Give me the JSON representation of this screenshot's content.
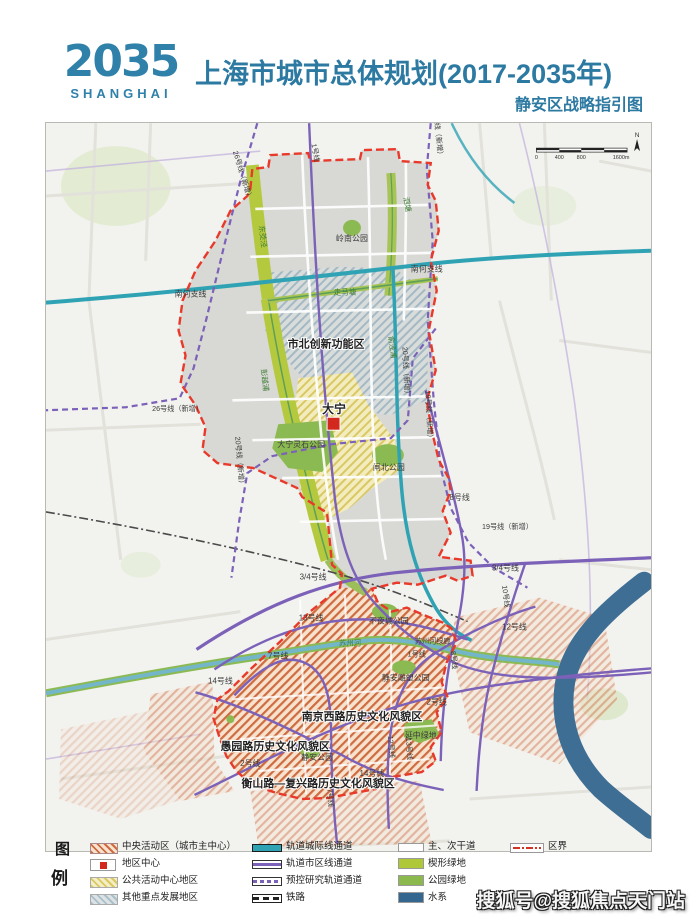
{
  "header": {
    "logo_year": "2035",
    "logo_city": "SHANGHAI",
    "title": "上海市城市总体规划(2017-2035年)",
    "subtitle": "静安区战略指引图"
  },
  "map": {
    "scale_bar": {
      "t0": "0",
      "t400": "400",
      "t800": "800",
      "t1600": "1600m",
      "north": "N"
    },
    "labels": [
      {
        "text": "26号线（新增）"
      },
      {
        "text": "1号线"
      },
      {
        "text": "19号线（新增）"
      },
      {
        "text": "岭南公园"
      },
      {
        "text": "泗塘"
      },
      {
        "text": "南何支线"
      },
      {
        "text": "南何支线"
      },
      {
        "text": "东茭泾"
      },
      {
        "text": "走马塘"
      },
      {
        "text": "市北创新功能区"
      },
      {
        "text": "彭越浦"
      },
      {
        "text": "俞泾浦"
      },
      {
        "text": "20号线（新增）"
      },
      {
        "text": "19号线（新增）"
      },
      {
        "text": "26号线（新增）"
      },
      {
        "text": "大宁"
      },
      {
        "text": "大宁灵石公园"
      },
      {
        "text": "闸北公园"
      },
      {
        "text": "20号线（新增）"
      },
      {
        "text": "8号线"
      },
      {
        "text": "19号线（新增）"
      },
      {
        "text": "3/4号线"
      },
      {
        "text": "3/4号线"
      },
      {
        "text": "10号线"
      },
      {
        "text": "13号线"
      },
      {
        "text": "不夜城公园"
      },
      {
        "text": "12号线"
      },
      {
        "text": "苏州河"
      },
      {
        "text": "苏州河绿廊"
      },
      {
        "text": "1号线"
      },
      {
        "text": "8号线"
      },
      {
        "text": "7号线"
      },
      {
        "text": "静安雕塑公园"
      },
      {
        "text": "14号线"
      },
      {
        "text": "2号线"
      },
      {
        "text": "南京西路历史文化风貌区"
      },
      {
        "text": "延中绿地"
      },
      {
        "text": "愚园路历史文化风貌区"
      },
      {
        "text": "静安公园"
      },
      {
        "text": "2号线"
      },
      {
        "text": "12号线"
      },
      {
        "text": "13号线"
      },
      {
        "text": "14号线"
      },
      {
        "text": "衡山路—复兴路历史文化风貌区"
      },
      {
        "text": "7号线"
      }
    ]
  },
  "legend": {
    "fig": "图",
    "li": "例",
    "items": [
      "中央活动区（城市主中心）",
      "轨道城际线通道",
      "主、次干道",
      "区界",
      "地区中心",
      "轨道市区线通道",
      "楔形绿地",
      "公共活动中心地区",
      "预控研究轨道通道",
      "公园绿地",
      "其他重点发展地区",
      "铁路",
      "水系"
    ]
  },
  "watermark": "搜狐号@搜狐焦点天门站",
  "colors": {
    "brand_teal": "#2c79a2",
    "metro_purple": "#7b61b8",
    "intercity_teal": "#2fa3b4",
    "boundary_red": "#e8392a",
    "wedge_green": "#aec838",
    "park_green": "#8cb94e",
    "water_blue": "#33678f",
    "district_center_red": "#d3281e"
  }
}
